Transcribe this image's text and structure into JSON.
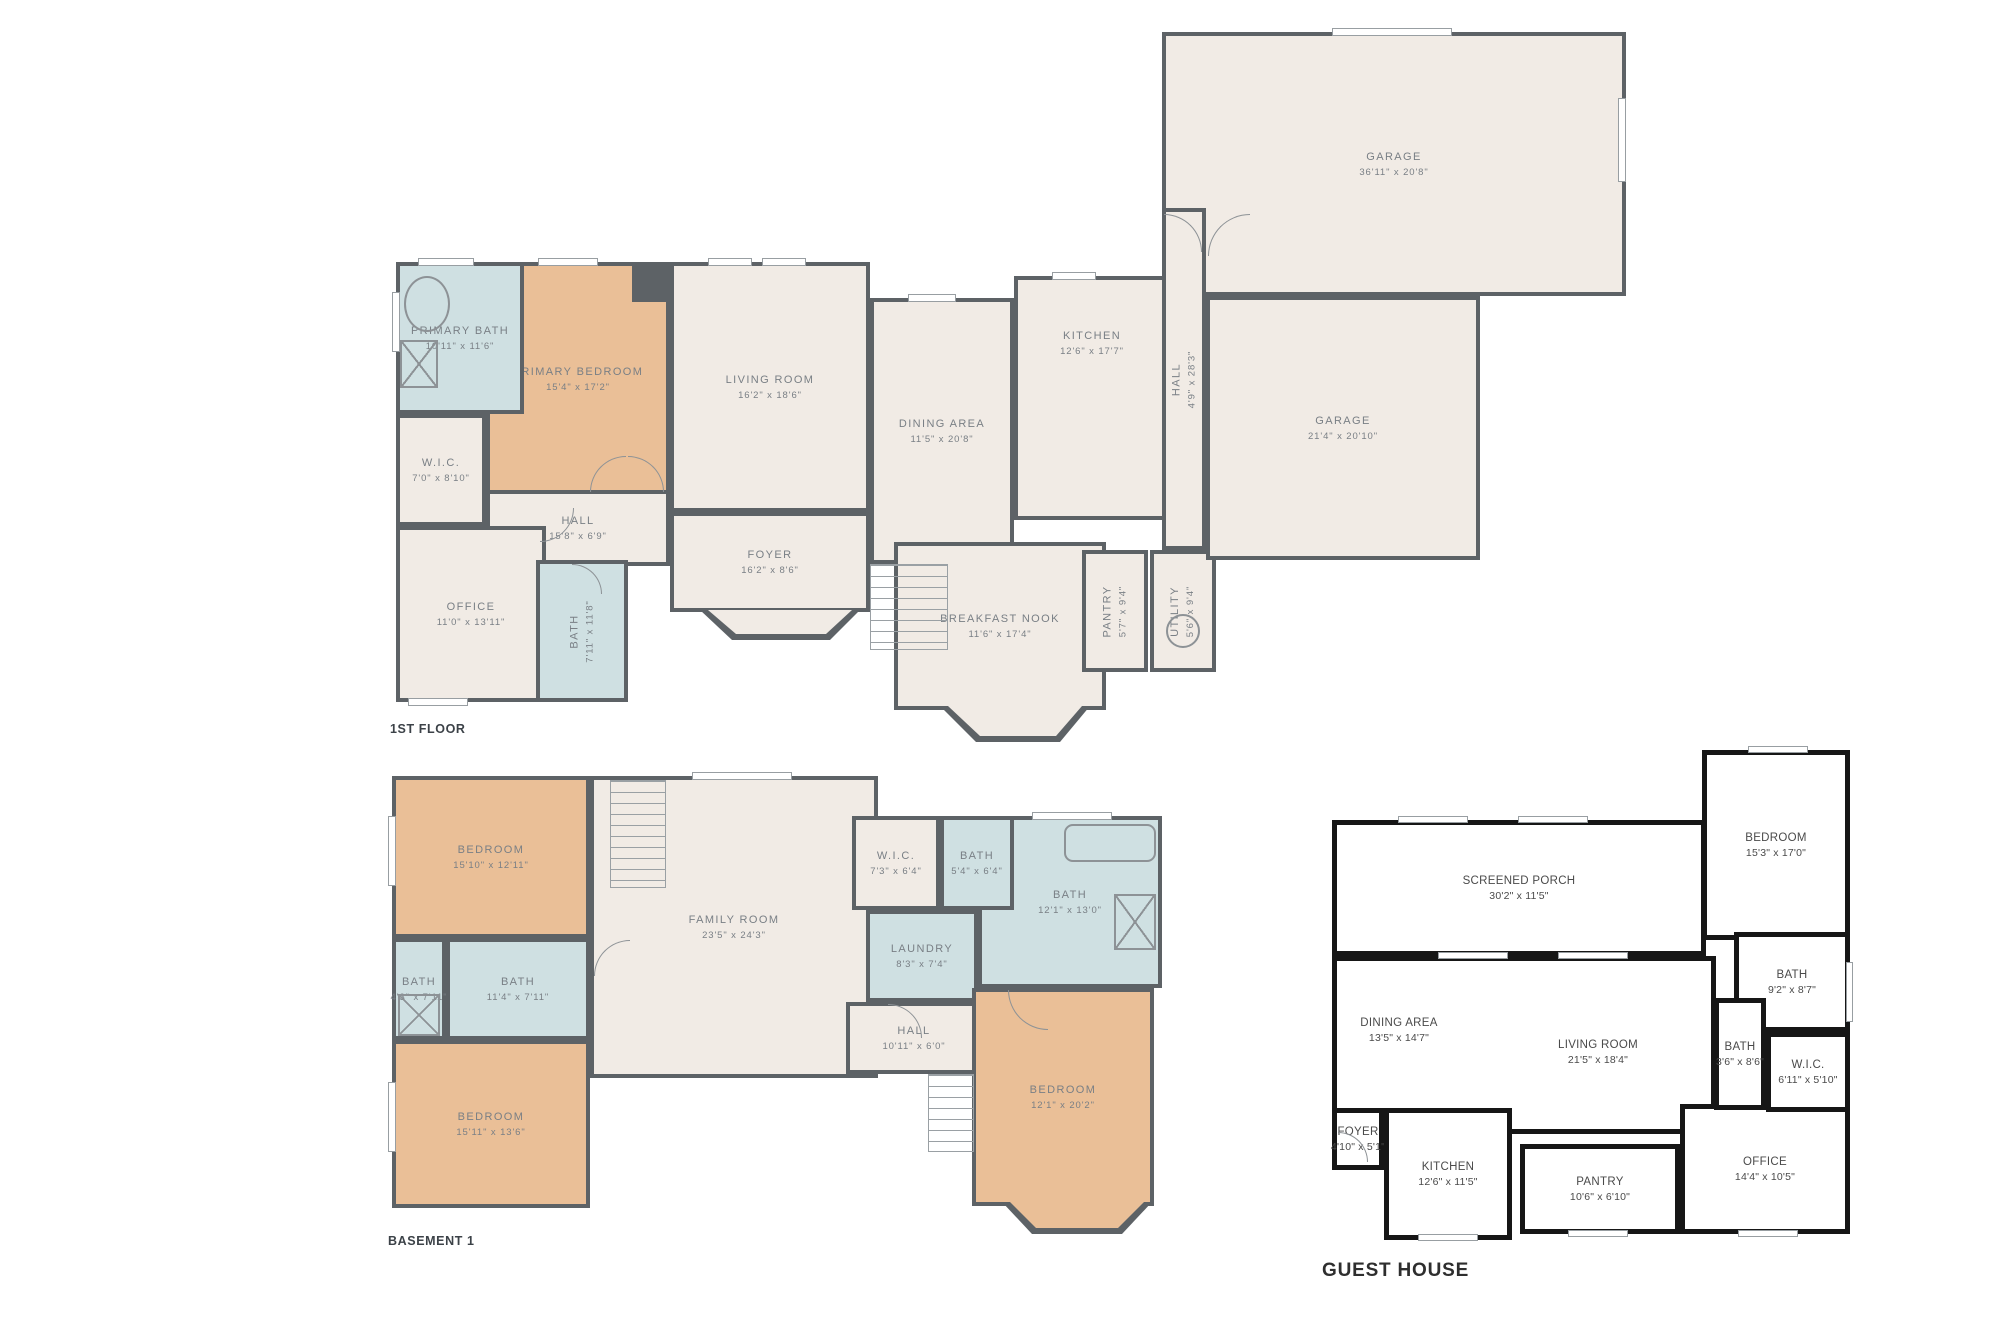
{
  "page": {
    "background": "#ffffff"
  },
  "colors": {
    "wall": "#5d6266",
    "gh_wall": "#161616",
    "cream": "#f1ebe5",
    "tan": "#eabf97",
    "blue": "#cfe0e2",
    "room_text": "#797f85",
    "gh_text": "#4a4a4a",
    "plan_label_text": "#3c4248"
  },
  "plans": [
    {
      "id": "first-floor",
      "label": "1ST FLOOR",
      "style": "warm",
      "x": 388,
      "y": 8,
      "w": 1245,
      "h": 748,
      "label_pos": {
        "x": 2,
        "y": 714
      },
      "rooms": [
        {
          "name": "PRIMARY BEDROOM",
          "dims": "15'4\" x 17'2\"",
          "fill": "tan",
          "x": 98,
          "y": 254,
          "w": 184,
          "h": 234
        },
        {
          "name": "PRIMARY BATH",
          "dims": "10'11\" x 11'6\"",
          "fill": "blue",
          "x": 8,
          "y": 254,
          "w": 128,
          "h": 152
        },
        {
          "name": "W.I.C.",
          "dims": "7'0\" x 8'10\"",
          "fill": "cream",
          "x": 8,
          "y": 406,
          "w": 90,
          "h": 112
        },
        {
          "name": "HALL",
          "dims": "15'8\" x 6'9\"",
          "fill": "cream",
          "x": 98,
          "y": 482,
          "w": 184,
          "h": 76
        },
        {
          "name": "OFFICE",
          "dims": "11'0\" x 13'11\"",
          "fill": "cream",
          "x": 8,
          "y": 518,
          "w": 150,
          "h": 176
        },
        {
          "name": "BATH",
          "dims": "7'11\" x 11'8\"",
          "fill": "blue",
          "vertical": true,
          "x": 148,
          "y": 552,
          "w": 92,
          "h": 142
        },
        {
          "name": "LIVING ROOM",
          "dims": "16'2\" x 18'6\"",
          "fill": "cream",
          "x": 282,
          "y": 254,
          "w": 200,
          "h": 250
        },
        {
          "name": "FOYER",
          "dims": "16'2\" x 8'6\"",
          "fill": "cream",
          "x": 282,
          "y": 504,
          "w": 200,
          "h": 100
        },
        {
          "name": "DINING AREA",
          "dims": "11'5\" x 20'8\"",
          "fill": "cream",
          "x": 482,
          "y": 290,
          "w": 144,
          "h": 266
        },
        {
          "name": "KITCHEN",
          "dims": "12'6\" x 17'7\"",
          "fill": "cream",
          "label_dy": -55,
          "x": 626,
          "y": 268,
          "w": 156,
          "h": 244
        },
        {
          "name": "BREAKFAST NOOK",
          "dims": "11'6\" x 17'4\"",
          "fill": "cream",
          "x": 506,
          "y": 534,
          "w": 212,
          "h": 168
        },
        {
          "name": "PANTRY",
          "dims": "5'7\" x 9'4\"",
          "fill": "cream",
          "vertical": true,
          "x": 694,
          "y": 542,
          "w": 66,
          "h": 122
        },
        {
          "name": "UTILITY",
          "dims": "5'6\" x 9'4\"",
          "fill": "cream",
          "vertical": true,
          "x": 762,
          "y": 542,
          "w": 66,
          "h": 122
        },
        {
          "name": "GARAGE",
          "dims": "36'11\" x 20'8\"",
          "fill": "cream",
          "x": 774,
          "y": 24,
          "w": 464,
          "h": 264
        },
        {
          "name": "HALL",
          "dims": "4'9\" x 28'3\"",
          "fill": "cream",
          "vertical": true,
          "x": 774,
          "y": 200,
          "w": 44,
          "h": 342
        },
        {
          "name": "GARAGE",
          "dims": "21'4\" x 20'10\"",
          "fill": "cream",
          "x": 818,
          "y": 288,
          "w": 274,
          "h": 264
        }
      ],
      "features": [
        {
          "type": "block",
          "name": "wall-notch",
          "x": 244,
          "y": 254,
          "w": 38,
          "h": 40
        },
        {
          "type": "tub",
          "name": "bathtub",
          "x": 16,
          "y": 268,
          "w": 46,
          "h": 56
        },
        {
          "type": "shower",
          "name": "shower-stall",
          "x": 12,
          "y": 332,
          "w": 38,
          "h": 48
        },
        {
          "type": "stairs",
          "name": "staircase",
          "x": 482,
          "y": 556,
          "w": 78,
          "h": 86
        },
        {
          "type": "circle",
          "name": "water-heater",
          "x": 778,
          "y": 606,
          "w": 34,
          "h": 34
        },
        {
          "type": "poly",
          "name": "bay-window-foyer",
          "color": "#5d6266",
          "pts": [
            [
              312,
              602
            ],
            [
              344,
              632
            ],
            [
              442,
              632
            ],
            [
              472,
              602
            ]
          ]
        },
        {
          "type": "poly",
          "name": "bay-window-foyer-inner",
          "color": "#f1ebe5",
          "pts": [
            [
              320,
              602
            ],
            [
              348,
              626
            ],
            [
              438,
              626
            ],
            [
              464,
              602
            ]
          ]
        },
        {
          "type": "poly",
          "name": "bay-window-nook",
          "color": "#5d6266",
          "pts": [
            [
              552,
              698
            ],
            [
              588,
              734
            ],
            [
              672,
              734
            ],
            [
              702,
              698
            ]
          ]
        },
        {
          "type": "poly",
          "name": "bay-window-nook-inner",
          "color": "#f1ebe5",
          "pts": [
            [
              560,
              698
            ],
            [
              592,
              728
            ],
            [
              668,
              728
            ],
            [
              694,
              698
            ]
          ]
        },
        {
          "type": "window",
          "name": "window",
          "x": 30,
          "y": 250,
          "w": 56,
          "h": 8
        },
        {
          "type": "window",
          "name": "window",
          "x": 150,
          "y": 250,
          "w": 60,
          "h": 8
        },
        {
          "type": "window",
          "name": "window",
          "x": 320,
          "y": 250,
          "w": 44,
          "h": 8
        },
        {
          "type": "window",
          "name": "window",
          "x": 374,
          "y": 250,
          "w": 44,
          "h": 8
        },
        {
          "type": "window",
          "name": "window",
          "x": 520,
          "y": 286,
          "w": 48,
          "h": 8
        },
        {
          "type": "window",
          "name": "window",
          "x": 664,
          "y": 264,
          "w": 44,
          "h": 8
        },
        {
          "type": "window",
          "name": "window",
          "x": 20,
          "y": 690,
          "w": 60,
          "h": 8
        },
        {
          "type": "window",
          "name": "window",
          "x": 944,
          "y": 20,
          "w": 120,
          "h": 8
        },
        {
          "type": "window",
          "name": "window",
          "x": 4,
          "y": 284,
          "w": 8,
          "h": 60
        },
        {
          "type": "window",
          "name": "window",
          "x": 1230,
          "y": 90,
          "w": 8,
          "h": 84
        },
        {
          "type": "arc tl",
          "name": "door-swing",
          "x": 202,
          "y": 448,
          "w": 36,
          "h": 36
        },
        {
          "type": "arc tr",
          "name": "door-swing",
          "x": 240,
          "y": 448,
          "w": 36,
          "h": 36
        },
        {
          "type": "arc tr",
          "name": "door-swing",
          "x": 776,
          "y": 206,
          "w": 38,
          "h": 38
        },
        {
          "type": "arc tl",
          "name": "door-swing",
          "x": 820,
          "y": 206,
          "w": 42,
          "h": 42
        },
        {
          "type": "arc br",
          "name": "door-swing",
          "x": 152,
          "y": 500,
          "w": 34,
          "h": 34
        },
        {
          "type": "arc tr",
          "name": "door-swing",
          "x": 184,
          "y": 556,
          "w": 30,
          "h": 30
        }
      ]
    },
    {
      "id": "basement-1",
      "label": "BASEMENT 1",
      "style": "warm",
      "x": 388,
      "y": 772,
      "w": 790,
      "h": 482,
      "label_pos": {
        "x": 0,
        "y": 462
      },
      "rooms": [
        {
          "name": "BEDROOM",
          "dims": "15'10\" x 12'11\"",
          "fill": "tan",
          "x": 4,
          "y": 4,
          "w": 198,
          "h": 162
        },
        {
          "name": "BATH",
          "dims": "4'3\" x 7'11\"",
          "fill": "blue",
          "x": 4,
          "y": 166,
          "w": 54,
          "h": 102
        },
        {
          "name": "BATH",
          "dims": "11'4\" x 7'11\"",
          "fill": "blue",
          "x": 58,
          "y": 166,
          "w": 144,
          "h": 102
        },
        {
          "name": "BEDROOM",
          "dims": "15'11\" x 13'6\"",
          "fill": "tan",
          "x": 4,
          "y": 268,
          "w": 198,
          "h": 168
        },
        {
          "name": "FAMILY ROOM",
          "dims": "23'5\" x 24'3\"",
          "fill": "cream",
          "x": 202,
          "y": 4,
          "w": 288,
          "h": 302
        },
        {
          "name": "BATH",
          "dims": "12'1\" x 13'0\"",
          "fill": "blue",
          "x": 590,
          "y": 44,
          "w": 184,
          "h": 172
        },
        {
          "name": "W.I.C.",
          "dims": "7'3\" x 6'4\"",
          "fill": "cream",
          "x": 464,
          "y": 44,
          "w": 88,
          "h": 94
        },
        {
          "name": "BATH",
          "dims": "5'4\" x 6'4\"",
          "fill": "blue",
          "x": 552,
          "y": 44,
          "w": 74,
          "h": 94
        },
        {
          "name": "LAUNDRY",
          "dims": "8'3\" x 7'4\"",
          "fill": "blue",
          "x": 478,
          "y": 138,
          "w": 112,
          "h": 92
        },
        {
          "name": "HALL",
          "dims": "10'11\" x 6'0\"",
          "fill": "cream",
          "x": 458,
          "y": 230,
          "w": 136,
          "h": 72
        },
        {
          "name": "BEDROOM",
          "dims": "12'1\" x 20'2\"",
          "fill": "tan",
          "x": 584,
          "y": 216,
          "w": 182,
          "h": 218
        }
      ],
      "features": [
        {
          "type": "stairs",
          "name": "staircase-up",
          "x": 222,
          "y": 8,
          "w": 56,
          "h": 108
        },
        {
          "type": "stairs",
          "name": "staircase-down",
          "x": 540,
          "y": 302,
          "w": 46,
          "h": 78
        },
        {
          "type": "shower",
          "name": "shower-stall",
          "x": 10,
          "y": 222,
          "w": 42,
          "h": 42
        },
        {
          "type": "shower",
          "name": "shower-stall",
          "x": 726,
          "y": 122,
          "w": 42,
          "h": 56
        },
        {
          "type": "tubr",
          "name": "bathtub",
          "x": 676,
          "y": 52,
          "w": 92,
          "h": 38
        },
        {
          "type": "poly",
          "name": "bay-window-bedroom",
          "color": "#5d6266",
          "pts": [
            [
              614,
              430
            ],
            [
              644,
              462
            ],
            [
              734,
              462
            ],
            [
              764,
              430
            ]
          ]
        },
        {
          "type": "poly",
          "name": "bay-window-bedroom-inner",
          "color": "#eabf97",
          "pts": [
            [
              622,
              430
            ],
            [
              648,
              456
            ],
            [
              730,
              456
            ],
            [
              756,
              430
            ]
          ]
        },
        {
          "type": "window",
          "name": "window",
          "x": 0,
          "y": 44,
          "w": 8,
          "h": 70
        },
        {
          "type": "window",
          "name": "window",
          "x": 0,
          "y": 310,
          "w": 8,
          "h": 70
        },
        {
          "type": "window",
          "name": "window",
          "x": 304,
          "y": 0,
          "w": 100,
          "h": 8
        },
        {
          "type": "window",
          "name": "window",
          "x": 644,
          "y": 40,
          "w": 80,
          "h": 8
        },
        {
          "type": "arc tr",
          "name": "door-swing",
          "x": 500,
          "y": 232,
          "w": 34,
          "h": 34
        },
        {
          "type": "arc bl",
          "name": "door-swing",
          "x": 620,
          "y": 218,
          "w": 40,
          "h": 40
        },
        {
          "type": "arc tl",
          "name": "door-swing",
          "x": 206,
          "y": 168,
          "w": 36,
          "h": 36
        }
      ]
    },
    {
      "id": "guest-house",
      "label": "GUEST HOUSE",
      "style": "gh",
      "x": 1318,
      "y": 742,
      "w": 565,
      "h": 548,
      "label_pos": {
        "x": 4,
        "y": 518
      },
      "rooms": [
        {
          "name": "SCREENED PORCH",
          "dims": "30'2\" x 11'5\"",
          "x": 14,
          "y": 78,
          "w": 374,
          "h": 136
        },
        {
          "name": "",
          "dims": "",
          "fill": "none",
          "x": 14,
          "y": 214,
          "w": 384,
          "h": 178
        },
        {
          "name": "DINING AREA",
          "dims": "13'5\" x 14'7\"",
          "label_only": true,
          "x": 26,
          "y": 268,
          "w": 110,
          "h": 40
        },
        {
          "name": "LIVING ROOM",
          "dims": "21'5\" x 18'4\"",
          "label_only": true,
          "x": 224,
          "y": 290,
          "w": 112,
          "h": 40
        },
        {
          "name": "FOYER",
          "dims": "4'10\" x 5'1\"",
          "x": 14,
          "y": 366,
          "w": 52,
          "h": 62
        },
        {
          "name": "KITCHEN",
          "dims": "12'6\" x 11'5\"",
          "x": 66,
          "y": 366,
          "w": 128,
          "h": 132
        },
        {
          "name": "PANTRY",
          "dims": "10'6\" x 6'10\"",
          "x": 202,
          "y": 402,
          "w": 160,
          "h": 90
        },
        {
          "name": "OFFICE",
          "dims": "14'4\" x 10'5\"",
          "x": 362,
          "y": 362,
          "w": 170,
          "h": 130
        },
        {
          "name": "BEDROOM",
          "dims": "15'3\" x 17'0\"",
          "x": 384,
          "y": 8,
          "w": 148,
          "h": 190
        },
        {
          "name": "BATH",
          "dims": "9'2\" x 8'7\"",
          "x": 416,
          "y": 190,
          "w": 116,
          "h": 100
        },
        {
          "name": "BATH",
          "dims": "3'6\" x 8'6\"",
          "x": 396,
          "y": 256,
          "w": 52,
          "h": 112
        },
        {
          "name": "W.I.C.",
          "dims": "6'11\" x 5'10\"",
          "x": 448,
          "y": 290,
          "w": 84,
          "h": 80
        }
      ],
      "features": [
        {
          "type": "window",
          "name": "window",
          "x": 80,
          "y": 74,
          "w": 70,
          "h": 7
        },
        {
          "type": "window",
          "name": "window",
          "x": 200,
          "y": 74,
          "w": 70,
          "h": 7
        },
        {
          "type": "window",
          "name": "window",
          "x": 120,
          "y": 210,
          "w": 70,
          "h": 7
        },
        {
          "type": "window",
          "name": "window",
          "x": 240,
          "y": 210,
          "w": 70,
          "h": 7
        },
        {
          "type": "window",
          "name": "window",
          "x": 430,
          "y": 4,
          "w": 60,
          "h": 7
        },
        {
          "type": "window",
          "name": "window",
          "x": 528,
          "y": 220,
          "w": 7,
          "h": 60
        },
        {
          "type": "window",
          "name": "window",
          "x": 100,
          "y": 492,
          "w": 60,
          "h": 7
        },
        {
          "type": "window",
          "name": "window",
          "x": 250,
          "y": 488,
          "w": 60,
          "h": 7
        },
        {
          "type": "window",
          "name": "window",
          "x": 420,
          "y": 488,
          "w": 60,
          "h": 7
        },
        {
          "type": "arc tr",
          "name": "entry-door-swing",
          "x": 20,
          "y": 390,
          "w": 30,
          "h": 30
        }
      ]
    }
  ]
}
